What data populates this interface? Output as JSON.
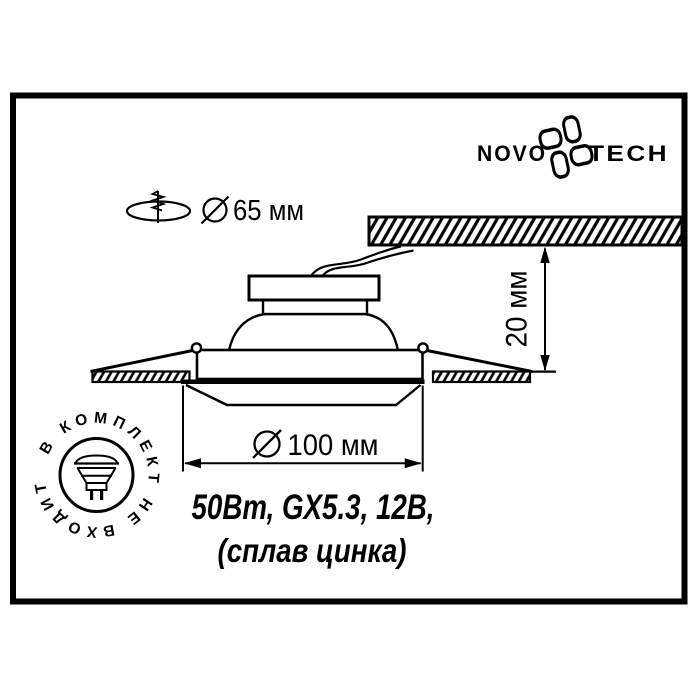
{
  "colors": {
    "ink": "#000000",
    "paper": "#ffffff"
  },
  "logo": {
    "left": "NOVO",
    "right": "TECH",
    "icon": "pinwheel-flower-icon"
  },
  "cutout": {
    "icon": "mounting-hole-spring-icon",
    "diameter_symbol": "Ø",
    "value": "65 мм"
  },
  "dim_depth": {
    "value": "20 мм"
  },
  "dim_width": {
    "diameter_symbol": "Ø",
    "value": "100 мм"
  },
  "specs": {
    "line1": "50Вт, GX5.3, 12В,",
    "line2": "(сплав цинка)"
  },
  "stamp": {
    "text": "В КОМПЛЕКТ НЕ ВХОДИТ",
    "icon": "mr16-lamp-icon"
  }
}
